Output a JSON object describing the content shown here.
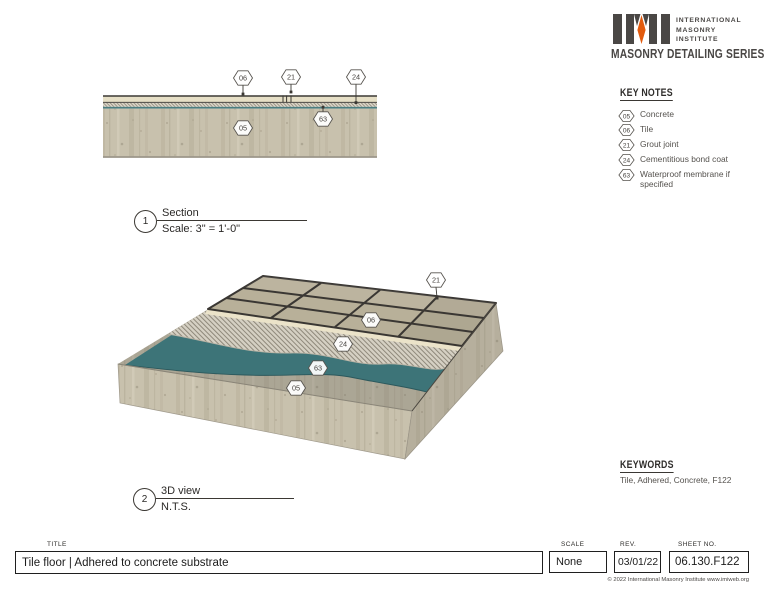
{
  "brand": {
    "logo_text": "IMI",
    "org_lines": [
      "INTERNATIONAL",
      "MASONRY",
      "INSTITUTE"
    ],
    "series_title": "MASONRY DETAILING SERIES"
  },
  "key_notes": {
    "heading": "KEY NOTES",
    "items": [
      {
        "num": "05",
        "label": "Concrete"
      },
      {
        "num": "06",
        "label": "Tile"
      },
      {
        "num": "21",
        "label": "Grout joint"
      },
      {
        "num": "24",
        "label": "Cementitious bond coat"
      },
      {
        "num": "63",
        "label": "Waterproof membrane if specified"
      }
    ]
  },
  "keywords": {
    "heading": "KEYWORDS",
    "text": "Tile, Adhered, Concrete, F122"
  },
  "views": {
    "section": {
      "number": "1",
      "name": "Section",
      "scale": "Scale: 3\" = 1'-0\"",
      "callouts": {
        "tile": "06",
        "grout": "21",
        "bond": "24",
        "membrane": "63",
        "concrete": "05"
      }
    },
    "three_d": {
      "number": "2",
      "name": "3D view",
      "scale": "N.T.S.",
      "callouts": {
        "grout": "21",
        "tile": "06",
        "bond": "24",
        "membrane": "63",
        "concrete": "05"
      }
    }
  },
  "title_block": {
    "title_label": "TITLE",
    "title_value": "Tile floor | Adhered to concrete substrate",
    "scale_label": "SCALE",
    "scale_value": "None",
    "rev_label": "REV.",
    "rev_value": "03/01/22",
    "sheet_label": "SHEET NO.",
    "sheet_value": "06.130.F122",
    "copyright": "© 2022 International Masonry Institute www.imiweb.org"
  },
  "colors": {
    "membrane_teal": "#3d7478",
    "tile_beige": "#b8b099",
    "concrete_light": "#c8c1ad",
    "grout_dark": "#3a3733",
    "accent_orange": "#e25b0e",
    "charcoal": "#4a4745"
  }
}
